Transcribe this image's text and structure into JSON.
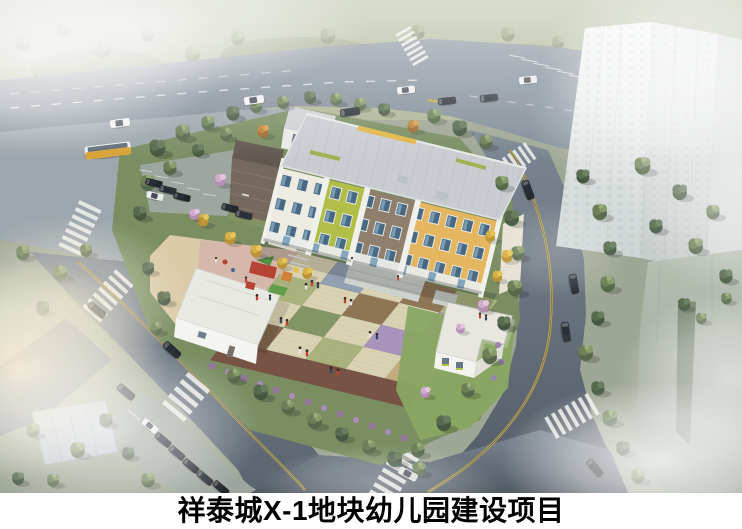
{
  "caption": {
    "text": "祥泰城X-1地块幼儿园建设项目"
  },
  "scene": {
    "alt": "Aerial architectural rendering of a kindergarten campus: an L-shaped building with white, lime, brown and yellow facade blocks, a patchwork paved courtyard with children, playground equipment, tree-lined ring roads with cars and a bus, and misty residential towers on the right",
    "courtyard": {
      "colors": {
        "cream": "#d9d2b0",
        "sage": "#a6b078",
        "olive": "#7e9160",
        "brown": "#8a6f4e",
        "bluegrey": "#8d9db0",
        "purple": "#a58fbc",
        "tan": "#c2a878",
        "darkbrown": "#7a5f43"
      },
      "grid": [
        [
          "cream",
          "bluegrey",
          "cream",
          "brown",
          "sage"
        ],
        [
          "sage",
          "cream",
          "brown",
          "cream",
          "purple"
        ],
        [
          "cream",
          "olive",
          "cream",
          "purple",
          "sage"
        ],
        [
          "darkbrown",
          "cream",
          "sage",
          "cream",
          "tan"
        ]
      ]
    },
    "palette": {
      "facade_white": "#efece0",
      "facade_lime": "#aebd3e",
      "facade_brown": "#8a7a66",
      "facade_yellow": "#e4b357",
      "annex_brown": "#6e6054",
      "roof_grey": "#c8ccd1",
      "road_grey": "#7d8894",
      "plaza_grey": "#98a2a9",
      "track_maroon": "#6f4a3a",
      "lane_yellow": "#c9a832",
      "bus_yellow": "#d79f2b",
      "tower_grey": "#dde2e0",
      "mist_white": "#ffffff"
    }
  }
}
